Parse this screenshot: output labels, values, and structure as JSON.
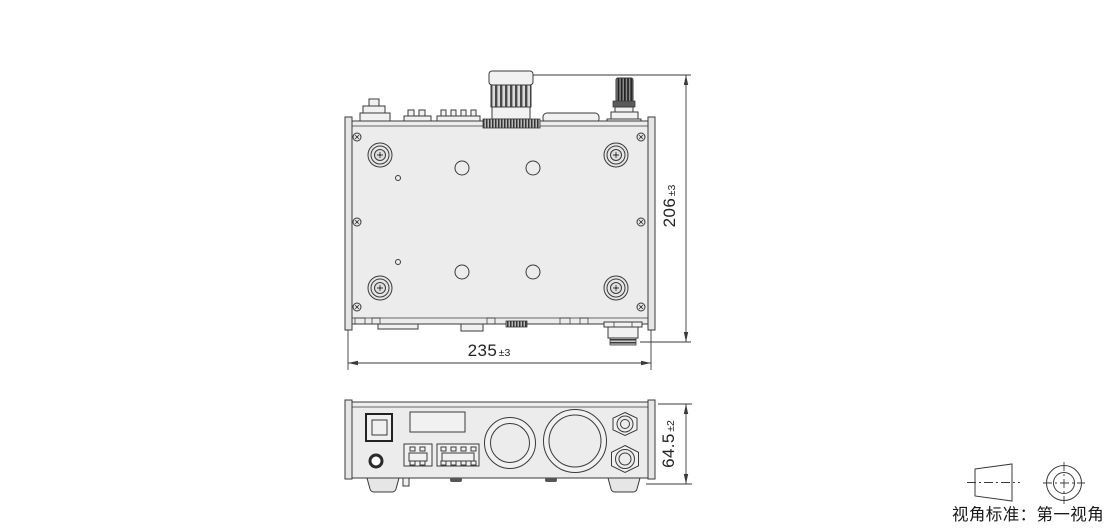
{
  "dimensions": {
    "width": {
      "value": "235",
      "tolerance": "±3"
    },
    "depth": {
      "value": "206",
      "tolerance": "±3"
    },
    "height": {
      "value": "64.5",
      "tolerance": "±2"
    }
  },
  "projection_note": {
    "label": "视角标准：第一视角"
  },
  "icons": {
    "first_angle_symbol": "first-angle-projection-symbol"
  },
  "colors": {
    "line": "#3a3a3a",
    "chassis_fill": "#ececec",
    "background": "#ffffff",
    "dark_fill": "#5a5a5a"
  }
}
